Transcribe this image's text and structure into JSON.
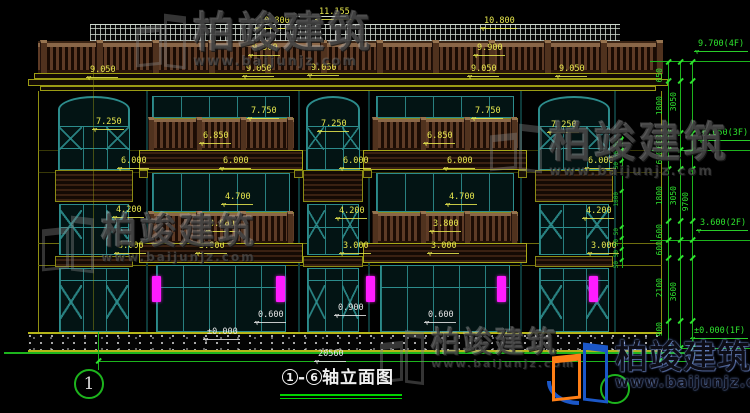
{
  "title_block": {
    "start_axis": "1",
    "separator": "-",
    "end_axis": "6",
    "name": "轴立面图",
    "left_axis_bubble": "1",
    "total_width_label": "20560"
  },
  "brand": {
    "name": "柏竣建筑",
    "url": "www.baijunjz.com"
  },
  "watermark": {
    "text": "柏竣建筑",
    "url": "www.baijunjz.com"
  },
  "watermark_positions": [
    {
      "x": 136,
      "y": 12,
      "icon_w": 50,
      "icon_h": 56,
      "char_size": 42,
      "url_size": 13
    },
    {
      "x": 490,
      "y": 122,
      "icon_w": 52,
      "icon_h": 50,
      "char_size": 42,
      "url_size": 13
    },
    {
      "x": 42,
      "y": 214,
      "icon_w": 52,
      "icon_h": 58,
      "char_size": 36,
      "url_size": 12
    },
    {
      "x": 380,
      "y": 328,
      "icon_w": 44,
      "icon_h": 56,
      "char_size": 29,
      "url_size": 11
    }
  ],
  "dims_yellow": [
    {
      "label": "11.155",
      "x": 315,
      "y": 8
    },
    {
      "label": "10.800",
      "x": 255,
      "y": 17
    },
    {
      "label": "10.800",
      "x": 480,
      "y": 17
    },
    {
      "label": "9.900",
      "x": 248,
      "y": 44
    },
    {
      "label": "9.900",
      "x": 473,
      "y": 44
    },
    {
      "label": "9.050",
      "x": 86,
      "y": 66
    },
    {
      "label": "9.050",
      "x": 242,
      "y": 65
    },
    {
      "label": "9.050",
      "x": 307,
      "y": 64
    },
    {
      "label": "9.050",
      "x": 467,
      "y": 65
    },
    {
      "label": "9.050",
      "x": 555,
      "y": 65
    },
    {
      "label": "7.750",
      "x": 247,
      "y": 107
    },
    {
      "label": "7.750",
      "x": 471,
      "y": 107
    },
    {
      "label": "7.250",
      "x": 92,
      "y": 118
    },
    {
      "label": "7.250",
      "x": 317,
      "y": 120
    },
    {
      "label": "7.250",
      "x": 547,
      "y": 121
    },
    {
      "label": "6.850",
      "x": 199,
      "y": 132
    },
    {
      "label": "6.850",
      "x": 423,
      "y": 132
    },
    {
      "label": "6.000",
      "x": 117,
      "y": 157
    },
    {
      "label": "6.000",
      "x": 219,
      "y": 157
    },
    {
      "label": "6.000",
      "x": 339,
      "y": 157
    },
    {
      "label": "6.000",
      "x": 443,
      "y": 157
    },
    {
      "label": "6.000",
      "x": 584,
      "y": 157
    },
    {
      "label": "4.700",
      "x": 221,
      "y": 193
    },
    {
      "label": "4.700",
      "x": 445,
      "y": 193
    },
    {
      "label": "4.200",
      "x": 112,
      "y": 206
    },
    {
      "label": "4.200",
      "x": 335,
      "y": 207
    },
    {
      "label": "4.200",
      "x": 582,
      "y": 207
    },
    {
      "label": "3.800",
      "x": 205,
      "y": 220
    },
    {
      "label": "3.800",
      "x": 429,
      "y": 220
    },
    {
      "label": "3.000",
      "x": 114,
      "y": 242
    },
    {
      "label": "3.000",
      "x": 195,
      "y": 242
    },
    {
      "label": "3.000",
      "x": 339,
      "y": 242
    },
    {
      "label": "3.000",
      "x": 427,
      "y": 242
    },
    {
      "label": "3.000",
      "x": 587,
      "y": 242
    }
  ],
  "dims_white": [
    {
      "label": "±0.000",
      "x": 203,
      "y": 328
    },
    {
      "label": "0.600",
      "x": 254,
      "y": 311
    },
    {
      "label": "0.600",
      "x": 424,
      "y": 311
    },
    {
      "label": "0.900",
      "x": 334,
      "y": 304
    },
    {
      "label": "20560",
      "x": 314,
      "y": 350
    }
  ],
  "elevation_flags": [
    {
      "label": "9.700(4F)",
      "x": 694,
      "y": 40,
      "ly": 61
    },
    {
      "label": "6.650(3F)",
      "x": 698,
      "y": 129,
      "ly": 150
    },
    {
      "label": "3.600(2F)",
      "x": 696,
      "y": 219,
      "ly": 240
    },
    {
      "label": "±0.000(1F)",
      "x": 690,
      "y": 327,
      "ly": 348
    }
  ],
  "green_dim_columns": {
    "col1": {
      "x": 656,
      "labels": [
        {
          "t": "650",
          "y": 68
        },
        {
          "t": "1800",
          "y": 96
        },
        {
          "t": "600",
          "y": 134
        },
        {
          "t": "650",
          "y": 150
        },
        {
          "t": "1800",
          "y": 186
        },
        {
          "t": "600",
          "y": 224
        },
        {
          "t": "600",
          "y": 241
        },
        {
          "t": "2100",
          "y": 278
        },
        {
          "t": "900",
          "y": 322
        }
      ]
    },
    "col2": {
      "x": 670,
      "labels": [
        {
          "t": "3050",
          "y": 92
        },
        {
          "t": "3050",
          "y": 186
        },
        {
          "t": "3600",
          "y": 282
        }
      ]
    },
    "col3": {
      "x": 682,
      "labels": [
        {
          "t": "9700",
          "y": 192
        }
      ]
    },
    "tick_ys": [
      62,
      81,
      133,
      150,
      169,
      221,
      240,
      258,
      321,
      348
    ],
    "line_xs": [
      668,
      680,
      692
    ]
  },
  "small_green_dims": {
    "x": 614,
    "labels": [
      {
        "t": "50",
        "y": 140
      },
      {
        "t": "50",
        "y": 151
      },
      {
        "t": "50",
        "y": 162
      },
      {
        "t": "1800",
        "y": 192
      },
      {
        "t": "50",
        "y": 228
      },
      {
        "t": "50",
        "y": 239
      },
      {
        "t": "50",
        "y": 250
      },
      {
        "t": "50",
        "y": 261
      }
    ]
  },
  "facade": {
    "bays": [
      {
        "type": "arch",
        "x": 55,
        "w": 78
      },
      {
        "type": "balcony",
        "x": 148,
        "w": 146
      },
      {
        "type": "arch",
        "x": 303,
        "w": 60
      },
      {
        "type": "balcony",
        "x": 372,
        "w": 146
      },
      {
        "type": "arch",
        "x": 535,
        "w": 78
      }
    ],
    "roof_posts": {
      "start": 40,
      "step": 56,
      "count": 12
    },
    "pilaster_xs": [
      146,
      298,
      368,
      520,
      614
    ]
  },
  "fixtures": {
    "wall_lamps": [
      {
        "x": 152,
        "y": 276
      },
      {
        "x": 276,
        "y": 276
      },
      {
        "x": 366,
        "y": 276
      },
      {
        "x": 497,
        "y": 276
      },
      {
        "x": 589,
        "y": 276
      }
    ]
  },
  "colors": {
    "dim_yellow": "#e8e84e",
    "olive_trim": "#9c9c14",
    "axis_green": "#1db41d",
    "bright_green": "#2ee22e",
    "teal_frame": "#2c8c8c",
    "balcony_wood": "#5e3b26",
    "lamp_magenta": "#ff1cff",
    "title_underline": "#00d400",
    "logo_orange": "#ff7f16",
    "logo_blue": "#1b57c8"
  }
}
